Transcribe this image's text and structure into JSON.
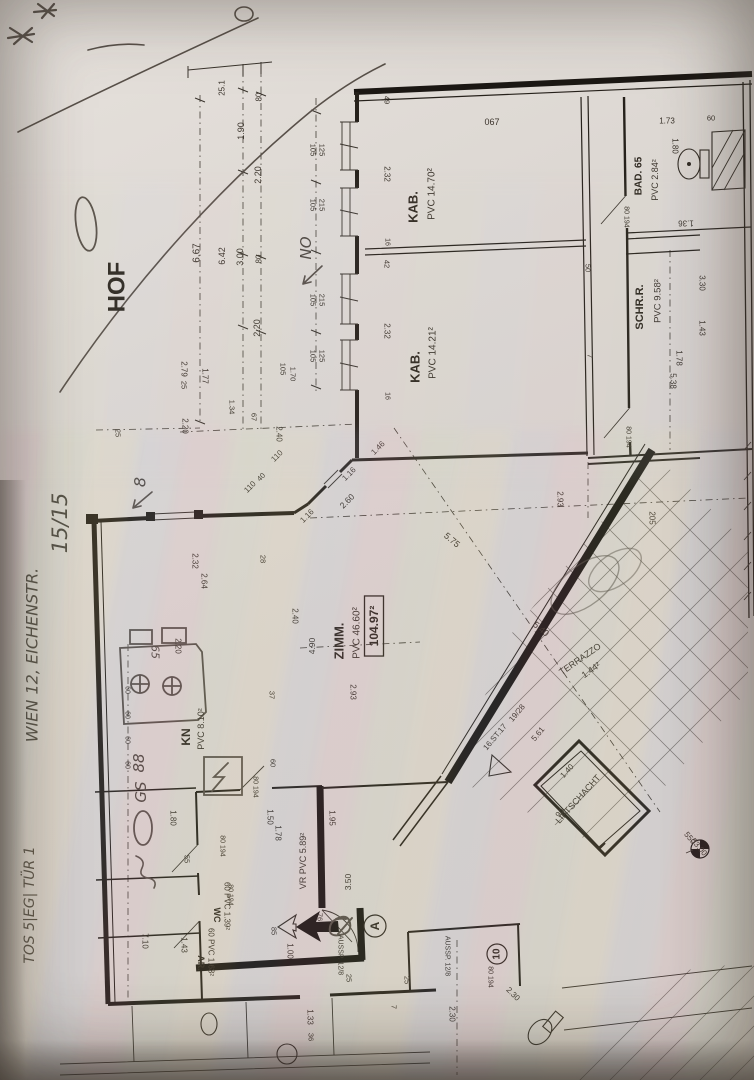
{
  "document": {
    "type": "photographed floor plan (Einreichplan), rotated 90°",
    "courtyard_label": "HOF",
    "total_area_boxed": "104.97²"
  },
  "rooms": [
    {
      "name": "hof",
      "label": "HOF"
    },
    {
      "name": "kabinett-1",
      "label": "KAB.",
      "area": "PVC 14.70²"
    },
    {
      "name": "kabinett-2",
      "label": "KAB.",
      "area": "PVC 14.21²"
    },
    {
      "name": "bad",
      "label": "BAD. 65",
      "area": "PVC 2.84²"
    },
    {
      "name": "schrankraum",
      "label": "SCHR.R.",
      "area": "PVC 9.58²"
    },
    {
      "name": "zimmer",
      "label": "ZIMM.",
      "area": "PVC 46.60²",
      "total": "104.97²"
    },
    {
      "name": "terrazzo",
      "label": "TERRAZZO",
      "area": "1.44²"
    },
    {
      "name": "liftschacht",
      "label": "LIFTSCHACHT",
      "dims": "1.40 / 90"
    },
    {
      "name": "treppe",
      "label": "16.ST.17",
      "steigung": "19/28"
    },
    {
      "name": "kueche",
      "label": "KN",
      "area": "PVC 8.10²"
    },
    {
      "name": "wc",
      "label": "WC",
      "area": "60 PVC 1.39²"
    },
    {
      "name": "abstellraum",
      "label": "AR.",
      "area": "60 PVC 1.63²"
    },
    {
      "name": "vorraum",
      "label": "VR PVC 5.89²"
    }
  ],
  "handwritten_notes": {
    "address": "WIEN 12, EICHENSTR.",
    "unit": "TOS 5|EG| TÜR 1",
    "sheet": "15/15",
    "orientation": "NO",
    "marks": [
      "8",
      "GS",
      "88",
      "O",
      "65",
      "10"
    ]
  },
  "labels": [
    {
      "n": "room-hof",
      "t": "HOF",
      "x": 117,
      "y": 287,
      "r": -90,
      "s": 24,
      "c": "pb"
    },
    {
      "n": "room-kab1",
      "t": "KAB.",
      "x": 413,
      "y": 207,
      "r": -90,
      "s": 13,
      "c": "pb"
    },
    {
      "n": "area-kab1",
      "t": "PVC 14.70²",
      "x": 432,
      "y": 194,
      "r": -90,
      "s": 10,
      "c": "p"
    },
    {
      "n": "room-kab2",
      "t": "KAB.",
      "x": 415,
      "y": 367,
      "r": -90,
      "s": 13,
      "c": "pb"
    },
    {
      "n": "area-kab2",
      "t": "PVC 14.21²",
      "x": 433,
      "y": 353,
      "r": -90,
      "s": 10,
      "c": "p"
    },
    {
      "n": "room-bad",
      "t": "BAD. 65",
      "x": 639,
      "y": 176,
      "r": -90,
      "s": 10,
      "c": "pb"
    },
    {
      "n": "area-bad",
      "t": "PVC 2.84²",
      "x": 655,
      "y": 180,
      "r": -90,
      "s": 9,
      "c": "p"
    },
    {
      "n": "room-schrr",
      "t": "SCHR.R.",
      "x": 640,
      "y": 307,
      "r": -90,
      "s": 11,
      "c": "pb"
    },
    {
      "n": "area-schrr",
      "t": "PVC 9.58²",
      "x": 658,
      "y": 301,
      "r": -90,
      "s": 9.5,
      "c": "p"
    },
    {
      "n": "room-zimm",
      "t": "ZIMM.",
      "x": 339,
      "y": 641,
      "r": -90,
      "s": 13,
      "c": "pb"
    },
    {
      "n": "area-zimm",
      "t": "PVC 46.60²",
      "x": 357,
      "y": 633,
      "r": -90,
      "s": 10,
      "c": "p"
    },
    {
      "n": "total-area",
      "t": "104.97²",
      "x": 374,
      "y": 626,
      "r": -90,
      "s": 12,
      "c": "pb",
      "box": 1
    },
    {
      "n": "room-terrazzo",
      "t": "TERRAZZO",
      "x": 580,
      "y": 659,
      "r": -35,
      "s": 9,
      "c": "p"
    },
    {
      "n": "area-terrazzo",
      "t": "1.44²",
      "x": 591,
      "y": 670,
      "r": -35,
      "s": 9,
      "c": "p"
    },
    {
      "n": "room-lift",
      "t": "LIFTSCHACHT",
      "x": 578,
      "y": 799,
      "r": -48,
      "s": 9,
      "c": "p"
    },
    {
      "n": "dim-lift-1",
      "t": "1.40",
      "x": 567,
      "y": 771,
      "r": -48,
      "s": 8,
      "c": "p"
    },
    {
      "n": "dim-lift-2",
      "t": "90",
      "x": 560,
      "y": 813,
      "r": -48,
      "s": 8,
      "c": "p"
    },
    {
      "n": "stair-steps",
      "t": "16.ST.17",
      "x": 495,
      "y": 737,
      "r": -50,
      "s": 8,
      "c": "p"
    },
    {
      "n": "stair-ratio",
      "t": "19/28",
      "x": 517,
      "y": 713,
      "r": -50,
      "s": 8,
      "c": "p"
    },
    {
      "n": "dim-stair",
      "t": "5.61",
      "x": 538,
      "y": 734,
      "r": -50,
      "s": 8,
      "c": "p"
    },
    {
      "n": "room-kn",
      "t": "KN",
      "x": 186,
      "y": 737,
      "r": -90,
      "s": 12,
      "c": "pb"
    },
    {
      "n": "area-kn",
      "t": "PVC 8.10²",
      "x": 201,
      "y": 729,
      "r": -90,
      "s": 9,
      "c": "p"
    },
    {
      "n": "room-wc",
      "t": "WC",
      "x": 217,
      "y": 915,
      "r": 90,
      "s": 9,
      "c": "pb"
    },
    {
      "n": "area-wc",
      "t": "60 PVC 1.39²",
      "x": 227,
      "y": 906,
      "r": 90,
      "s": 8,
      "c": "p"
    },
    {
      "n": "room-ar",
      "t": "AR.",
      "x": 201,
      "y": 963,
      "r": 90,
      "s": 9,
      "c": "pb"
    },
    {
      "n": "area-ar",
      "t": "60 PVC 1.63²",
      "x": 211,
      "y": 952,
      "r": 90,
      "s": 8,
      "c": "p"
    },
    {
      "n": "room-vr",
      "t": "VR PVC 5.89²",
      "x": 303,
      "y": 861,
      "r": -90,
      "s": 9,
      "c": "p"
    },
    {
      "n": "aussp-1",
      "t": "AUSSP. 12/8",
      "x": 340,
      "y": 955,
      "r": 90,
      "s": 7,
      "c": "p"
    },
    {
      "n": "aussp-2",
      "t": "AUSSP. 12/8",
      "x": 447,
      "y": 956,
      "r": 90,
      "s": 7,
      "c": "p"
    },
    {
      "n": "pos-10",
      "t": "10",
      "x": 497,
      "y": 954,
      "r": -90,
      "s": 10,
      "c": "pb",
      "circ": 10
    },
    {
      "n": "pos-a",
      "t": "A",
      "x": 375,
      "y": 926,
      "r": -90,
      "s": 12,
      "c": "pb",
      "circ": 11
    },
    {
      "n": "bench-550",
      "t": "550",
      "x": 690,
      "y": 838,
      "r": 50,
      "s": 8,
      "c": "p"
    },
    {
      "n": "bench-5300",
      "t": "53.00",
      "x": 699,
      "y": 847,
      "r": 50,
      "s": 8,
      "c": "p"
    },
    {
      "n": "num-067",
      "t": "067",
      "x": 492,
      "y": 122,
      "r": 0,
      "s": 9,
      "c": "p"
    },
    {
      "n": "dim-251",
      "t": "25.1",
      "x": 222,
      "y": 88,
      "r": -90,
      "s": 8,
      "c": "p"
    },
    {
      "n": "dim-80a",
      "t": "80",
      "x": 259,
      "y": 97,
      "r": -90,
      "s": 8,
      "c": "p"
    },
    {
      "n": "dim-190",
      "t": "1.90",
      "x": 241,
      "y": 131,
      "r": -90,
      "s": 9,
      "c": "p"
    },
    {
      "n": "dim-220a",
      "t": "2.20",
      "x": 258,
      "y": 175,
      "r": -90,
      "s": 9,
      "c": "p"
    },
    {
      "n": "dim-667",
      "t": "6.67",
      "x": 197,
      "y": 253,
      "r": -90,
      "s": 10,
      "c": "p"
    },
    {
      "n": "dim-642",
      "t": "6.42",
      "x": 222,
      "y": 256,
      "r": -90,
      "s": 9,
      "c": "p"
    },
    {
      "n": "dim-300",
      "t": "3.00",
      "x": 240,
      "y": 257,
      "r": -90,
      "s": 9,
      "c": "p"
    },
    {
      "n": "dim-80b",
      "t": "80",
      "x": 259,
      "y": 259,
      "r": -90,
      "s": 8,
      "c": "p"
    },
    {
      "n": "dim-220b",
      "t": "2.20",
      "x": 257,
      "y": 328,
      "r": -90,
      "s": 9,
      "c": "p"
    },
    {
      "n": "dim-105a",
      "t": "105",
      "x": 283,
      "y": 369,
      "r": 90,
      "s": 7.5,
      "c": "p"
    },
    {
      "n": "dim-170",
      "t": "1.70",
      "x": 293,
      "y": 374,
      "r": 90,
      "s": 7.5,
      "c": "p"
    },
    {
      "n": "dim-279",
      "t": "2.79",
      "x": 184,
      "y": 369,
      "r": 90,
      "s": 8,
      "c": "p"
    },
    {
      "n": "dim-25a",
      "t": "25",
      "x": 184,
      "y": 385,
      "r": 90,
      "s": 7.5,
      "c": "p"
    },
    {
      "n": "dim-177",
      "t": "1.77",
      "x": 205,
      "y": 376,
      "r": 90,
      "s": 8,
      "c": "p"
    },
    {
      "n": "dim-134",
      "t": "1.34",
      "x": 232,
      "y": 407,
      "r": 90,
      "s": 7.5,
      "c": "p"
    },
    {
      "n": "dim-67",
      "t": "67",
      "x": 254,
      "y": 417,
      "r": 90,
      "s": 7.5,
      "c": "p"
    },
    {
      "n": "dim-240a",
      "t": "2.40",
      "x": 279,
      "y": 434,
      "r": 90,
      "s": 8,
      "c": "p"
    },
    {
      "n": "dim-110a",
      "t": "110",
      "x": 277,
      "y": 456,
      "r": -45,
      "s": 8,
      "c": "p"
    },
    {
      "n": "dim-220c",
      "t": "2.20",
      "x": 185,
      "y": 426,
      "r": 90,
      "s": 8,
      "c": "p"
    },
    {
      "n": "dim-25b",
      "t": "25",
      "x": 118,
      "y": 433,
      "r": 90,
      "s": 7.5,
      "c": "p"
    },
    {
      "n": "dim-232a",
      "t": "2.32",
      "x": 195,
      "y": 561,
      "r": 90,
      "s": 8,
      "c": "p"
    },
    {
      "n": "dim-264",
      "t": "2.64",
      "x": 204,
      "y": 581,
      "r": 90,
      "s": 8,
      "c": "p"
    },
    {
      "n": "dim-28",
      "t": "28",
      "x": 263,
      "y": 559,
      "r": 90,
      "s": 7.5,
      "c": "p"
    },
    {
      "n": "win1-a",
      "t": "105",
      "x": 313,
      "y": 150,
      "r": 90,
      "s": 7.5,
      "c": "p"
    },
    {
      "n": "win1-b",
      "t": "125",
      "x": 322,
      "y": 150,
      "r": 90,
      "s": 7.5,
      "c": "p"
    },
    {
      "n": "win2-a",
      "t": "105",
      "x": 313,
      "y": 205,
      "r": 90,
      "s": 7.5,
      "c": "p"
    },
    {
      "n": "win2-b",
      "t": "215",
      "x": 322,
      "y": 205,
      "r": 90,
      "s": 7.5,
      "c": "p"
    },
    {
      "n": "win3-a",
      "t": "105",
      "x": 313,
      "y": 300,
      "r": 90,
      "s": 7.5,
      "c": "p"
    },
    {
      "n": "win3-b",
      "t": "215",
      "x": 322,
      "y": 300,
      "r": 90,
      "s": 7.5,
      "c": "p"
    },
    {
      "n": "win4-a",
      "t": "105",
      "x": 313,
      "y": 356,
      "r": 90,
      "s": 7.5,
      "c": "p"
    },
    {
      "n": "win4-b",
      "t": "125",
      "x": 322,
      "y": 356,
      "r": 90,
      "s": 7.5,
      "c": "p"
    },
    {
      "n": "dim-49",
      "t": "49",
      "x": 387,
      "y": 100,
      "r": 90,
      "s": 7.5,
      "c": "p"
    },
    {
      "n": "dim-232b",
      "t": "2.32",
      "x": 387,
      "y": 174,
      "r": 90,
      "s": 8,
      "c": "p"
    },
    {
      "n": "dim-16a",
      "t": "16",
      "x": 387,
      "y": 242,
      "r": 90,
      "s": 7,
      "c": "p"
    },
    {
      "n": "dim-42",
      "t": "42",
      "x": 387,
      "y": 264,
      "r": 90,
      "s": 7.5,
      "c": "p"
    },
    {
      "n": "dim-232c",
      "t": "2.32",
      "x": 387,
      "y": 331,
      "r": 90,
      "s": 8,
      "c": "p"
    },
    {
      "n": "dim-16b",
      "t": "16",
      "x": 387,
      "y": 396,
      "r": 90,
      "s": 7,
      "c": "p"
    },
    {
      "n": "dim-173",
      "t": "1.73",
      "x": 667,
      "y": 121,
      "r": 0,
      "s": 8,
      "c": "p"
    },
    {
      "n": "dim-60a",
      "t": "60",
      "x": 711,
      "y": 118,
      "r": 0,
      "s": 7.5,
      "c": "p"
    },
    {
      "n": "dim-180a",
      "t": "1.80",
      "x": 675,
      "y": 146,
      "r": 90,
      "s": 8,
      "c": "p"
    },
    {
      "n": "dim-136",
      "t": "1.36",
      "x": 686,
      "y": 223,
      "r": 180,
      "s": 8,
      "c": "p"
    },
    {
      "n": "dim-330a",
      "t": "3.30",
      "x": 702,
      "y": 283,
      "r": 90,
      "s": 8,
      "c": "p"
    },
    {
      "n": "door-bad",
      "t": "80 194",
      "x": 626,
      "y": 217,
      "r": 90,
      "s": 7,
      "c": "p"
    },
    {
      "n": "door-schrr",
      "t": "80 194",
      "x": 628,
      "y": 437,
      "r": 90,
      "s": 7,
      "c": "p"
    },
    {
      "n": "door-kn",
      "t": "80 194",
      "x": 255,
      "y": 787,
      "r": 90,
      "s": 7,
      "c": "p"
    },
    {
      "n": "door-wc",
      "t": "80 194",
      "x": 222,
      "y": 846,
      "r": 90,
      "s": 7,
      "c": "p"
    },
    {
      "n": "door-ar",
      "t": "80 194",
      "x": 230,
      "y": 895,
      "r": 90,
      "s": 7,
      "c": "p"
    },
    {
      "n": "door-haus",
      "t": "80 194",
      "x": 490,
      "y": 977,
      "r": 90,
      "s": 7,
      "c": "p"
    },
    {
      "n": "dim-50",
      "t": "50",
      "x": 588,
      "y": 268,
      "r": 90,
      "s": 7.5,
      "c": "p"
    },
    {
      "n": "dim-7a",
      "t": "7",
      "x": 590,
      "y": 356,
      "r": 90,
      "s": 7.5,
      "c": "p"
    },
    {
      "n": "dim-538",
      "t": "5.38",
      "x": 673,
      "y": 381,
      "r": 90,
      "s": 8,
      "c": "p"
    },
    {
      "n": "dim-178a",
      "t": "1.78",
      "x": 679,
      "y": 358,
      "r": 90,
      "s": 8,
      "c": "p"
    },
    {
      "n": "dim-143a",
      "t": "1.43",
      "x": 702,
      "y": 328,
      "r": 90,
      "s": 8,
      "c": "p"
    },
    {
      "n": "dim-293a",
      "t": "2.93",
      "x": 353,
      "y": 692,
      "r": 90,
      "s": 8,
      "c": "p"
    },
    {
      "n": "dim-293b",
      "t": "2.93",
      "x": 560,
      "y": 499,
      "r": 90,
      "s": 8,
      "c": "p"
    },
    {
      "n": "dim-205",
      "t": "205",
      "x": 652,
      "y": 518,
      "r": 90,
      "s": 8,
      "c": "p"
    },
    {
      "n": "dim-575",
      "t": "5.75",
      "x": 452,
      "y": 540,
      "r": 40,
      "s": 9,
      "c": "p"
    },
    {
      "n": "dim-540",
      "t": "5.40",
      "x": 541,
      "y": 629,
      "r": 40,
      "s": 9,
      "c": "p"
    },
    {
      "n": "dim-116a",
      "t": "1.16",
      "x": 349,
      "y": 474,
      "r": -45,
      "s": 8,
      "c": "p"
    },
    {
      "n": "dim-260",
      "t": "2.60",
      "x": 347,
      "y": 501,
      "r": -45,
      "s": 8.5,
      "c": "p"
    },
    {
      "n": "dim-116b",
      "t": "1.16",
      "x": 307,
      "y": 516,
      "r": -45,
      "s": 8,
      "c": "p"
    },
    {
      "n": "dim-146",
      "t": "1.46",
      "x": 378,
      "y": 448,
      "r": -45,
      "s": 8,
      "c": "p"
    },
    {
      "n": "dim-110b",
      "t": "110",
      "x": 250,
      "y": 487,
      "r": -45,
      "s": 8,
      "c": "p"
    },
    {
      "n": "dim-40",
      "t": "40",
      "x": 261,
      "y": 477,
      "r": -45,
      "s": 7.5,
      "c": "p"
    },
    {
      "n": "dim-240b",
      "t": "2.40",
      "x": 295,
      "y": 616,
      "r": 90,
      "s": 8,
      "c": "p"
    },
    {
      "n": "dim-490",
      "t": "4.90",
      "x": 312,
      "y": 646,
      "r": -90,
      "s": 8.5,
      "c": "p"
    },
    {
      "n": "dim-220d",
      "t": "2.20",
      "x": 178,
      "y": 646,
      "r": 90,
      "s": 8,
      "c": "p"
    },
    {
      "n": "dim-37",
      "t": "37",
      "x": 272,
      "y": 695,
      "r": 90,
      "s": 7.5,
      "c": "p"
    },
    {
      "n": "dim-60b",
      "t": "60",
      "x": 273,
      "y": 763,
      "r": 90,
      "s": 7.5,
      "c": "p"
    },
    {
      "n": "kchain-1",
      "t": "60",
      "x": 127,
      "y": 690,
      "r": 90,
      "s": 7,
      "c": "p"
    },
    {
      "n": "kchain-2",
      "t": "60",
      "x": 127,
      "y": 715,
      "r": 90,
      "s": 7,
      "c": "p"
    },
    {
      "n": "kchain-3",
      "t": "60",
      "x": 127,
      "y": 740,
      "r": 90,
      "s": 7,
      "c": "p"
    },
    {
      "n": "kchain-4",
      "t": "60",
      "x": 127,
      "y": 765,
      "r": 90,
      "s": 7,
      "c": "p"
    },
    {
      "n": "dim-180b",
      "t": "1.80",
      "x": 173,
      "y": 818,
      "r": 90,
      "s": 8,
      "c": "p"
    },
    {
      "n": "dim-150",
      "t": "1.50",
      "x": 270,
      "y": 817,
      "r": 90,
      "s": 8,
      "c": "p"
    },
    {
      "n": "dim-178b",
      "t": "1.78",
      "x": 278,
      "y": 833,
      "r": 90,
      "s": 8,
      "c": "p"
    },
    {
      "n": "dim-55a",
      "t": "55",
      "x": 187,
      "y": 859,
      "r": 90,
      "s": 7.5,
      "c": "p"
    },
    {
      "n": "dim-710",
      "t": "7.10",
      "x": 145,
      "y": 941,
      "r": 90,
      "s": 8,
      "c": "p"
    },
    {
      "n": "dim-143b",
      "t": "1.43",
      "x": 184,
      "y": 945,
      "r": 90,
      "s": 8,
      "c": "p"
    },
    {
      "n": "dim-100",
      "t": "1.00",
      "x": 290,
      "y": 951,
      "r": 90,
      "s": 8,
      "c": "p"
    },
    {
      "n": "dim-85",
      "t": "85",
      "x": 274,
      "y": 931,
      "r": 90,
      "s": 7.5,
      "c": "p"
    },
    {
      "n": "dim-76",
      "t": "76",
      "x": 320,
      "y": 917,
      "r": 90,
      "s": 7.5,
      "c": "p"
    },
    {
      "n": "dim-25c",
      "t": "25",
      "x": 349,
      "y": 978,
      "r": 90,
      "s": 7.5,
      "c": "p"
    },
    {
      "n": "dim-133",
      "t": "1.33",
      "x": 310,
      "y": 1017,
      "r": 90,
      "s": 8,
      "c": "p"
    },
    {
      "n": "dim-36",
      "t": "36",
      "x": 311,
      "y": 1037,
      "r": 90,
      "s": 7.5,
      "c": "p"
    },
    {
      "n": "dim-25d",
      "t": "25",
      "x": 407,
      "y": 980,
      "r": 90,
      "s": 7.5,
      "c": "p"
    },
    {
      "n": "dim-7b",
      "t": "7",
      "x": 394,
      "y": 1007,
      "r": 90,
      "s": 7.5,
      "c": "p"
    },
    {
      "n": "dim-230a",
      "t": "2.30",
      "x": 513,
      "y": 994,
      "r": 45,
      "s": 8,
      "c": "p"
    },
    {
      "n": "dim-230b",
      "t": "2.30",
      "x": 452,
      "y": 1014,
      "r": 90,
      "s": 8,
      "c": "p"
    },
    {
      "n": "dim-350",
      "t": "3.50",
      "x": 348,
      "y": 882,
      "r": -90,
      "s": 8.5,
      "c": "p"
    },
    {
      "n": "dim-195",
      "t": "1.95",
      "x": 332,
      "y": 818,
      "r": 90,
      "s": 8,
      "c": "p"
    },
    {
      "n": "pen-no",
      "t": "NO",
      "x": 306,
      "y": 248,
      "r": -90,
      "s": 15,
      "c": "pen"
    },
    {
      "n": "pen-8",
      "t": "8",
      "x": 140,
      "y": 482,
      "r": -90,
      "s": 16,
      "c": "pen"
    },
    {
      "n": "pen-1515",
      "t": "15/15",
      "x": 60,
      "y": 523,
      "r": -90,
      "s": 21,
      "c": "pen"
    },
    {
      "n": "pen-address",
      "t": "WIEN 12, EICHENSTR.",
      "x": 32,
      "y": 655,
      "r": -90,
      "s": 16,
      "c": "pen"
    },
    {
      "n": "pen-unit",
      "t": "TOS 5|EG| TÜR 1",
      "x": 30,
      "y": 905,
      "r": -90,
      "s": 14,
      "c": "pen"
    },
    {
      "n": "pen-gs",
      "t": "GS",
      "x": 141,
      "y": 792,
      "r": -90,
      "s": 15,
      "c": "pen"
    },
    {
      "n": "pen-88",
      "t": "88",
      "x": 139,
      "y": 763,
      "r": -90,
      "s": 15,
      "c": "pen"
    },
    {
      "n": "pen-65",
      "t": "65",
      "x": 155,
      "y": 652,
      "r": 90,
      "s": 11,
      "c": "pen"
    }
  ],
  "colors": {
    "paper": "#ddd8d3",
    "ink": "#2b2520",
    "pen": "#4e4740"
  }
}
